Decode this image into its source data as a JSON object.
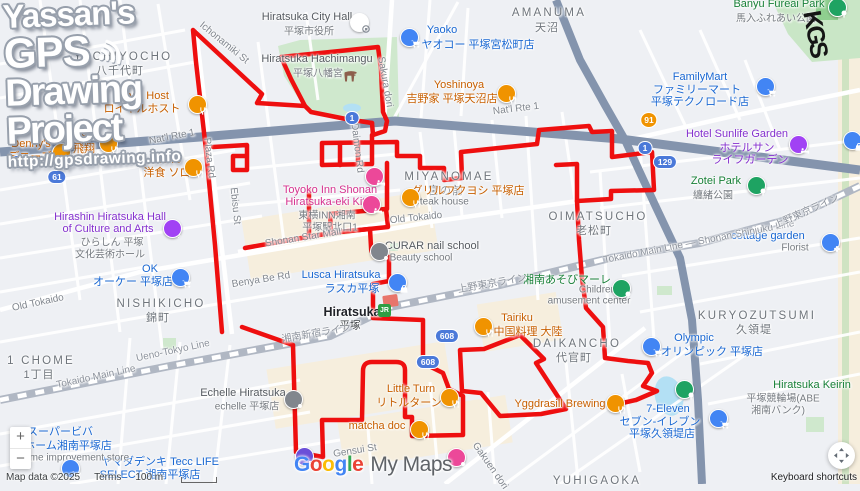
{
  "watermark": {
    "line1": "Yassan's",
    "line2": "GPS",
    "line3": "Drawing",
    "line4": "Project",
    "url": "http://gpsdrawing.info",
    "graffiti": "KGS"
  },
  "brand": {
    "google": "Google",
    "google_colors": [
      "#4285F4",
      "#EA4335",
      "#FBBC04",
      "#4285F4",
      "#34A853",
      "#EA4335"
    ],
    "mymaps": "My Maps"
  },
  "attribution": {
    "map_data": "Map data ©2025",
    "terms": "Terms",
    "scale": "100 m",
    "keyboard": "Keyboard shortcuts"
  },
  "controls": {
    "zoom_in": "+",
    "zoom_out": "−"
  },
  "station": {
    "jr_label": "JR"
  },
  "gps_track": {
    "color": "#ee0f0f",
    "width": 4.5,
    "strokes": [
      "M222,332 L215,245 L206,150 L196,62 L193,30 L262,94 L257,103 L305,106 L311,112 L346,119 L372,123",
      "M305,106 L291,79 L281,57 L340,51 L378,47 L381,70 L383,112 L387,121 L385,131 L373,135 L372,123",
      "M372,135 L372,164 L322,165 L322,143 L397,142 L397,156 L420,156 L420,168 L444,168 L444,180 L462,178 L461,152 L537,144 L539,130 L589,126 L592,132 L612,131 L612,157 L652,152 L654,190 L611,191 L611,199 L577,201 L579,240 L582,278 L586,308 L603,327 L605,358 L628,361 L648,363 L652,373 L643,386 L657,391 L636,400 L618,404",
      "M577,201 L577,164 L556,165",
      "M340,143 L340,165",
      "M358,142 L358,164",
      "M331,233 L330,214 L386,209 L388,227 L331,233",
      "M387,209 L387,163",
      "M213,147 L247,145 L247,170 L233,170 L233,156 L245,156",
      "M245,248 L290,240 L337,232 L370,229 L371,247 Q371,257 381,257 L389,257 L389,281 L373,284 L373,318 L398,319 L423,320 L423,363 L443,373 L449,389 L463,396 L463,435 L412,436 L412,417 L405,417 L405,370 Q405,362 396,362 L372,362 Q363,362 363,371 L362,420 L322,420 L323,457 L296,452 L293,345 L242,327",
      "M460,350 L484,349 L520,335 L544,359 L536,363 L566,409 L541,414 L500,416 L481,393 L462,391 L460,350",
      "M309,190 L309,237"
    ]
  },
  "map_texts": [
    {
      "t": "YACHIYOCHO",
      "x": 123,
      "y": 57,
      "cls": "dist"
    },
    {
      "t": "八千代町",
      "x": 120,
      "y": 70,
      "cls": "distk"
    },
    {
      "t": "MIYANOMAE",
      "x": 449,
      "y": 177,
      "cls": "dist"
    },
    {
      "t": "宮の前",
      "x": 446,
      "y": 190,
      "cls": "distk"
    },
    {
      "t": "AMANUMA",
      "x": 549,
      "y": 13,
      "cls": "dist"
    },
    {
      "t": "天沼",
      "x": 547,
      "y": 27,
      "cls": "distk"
    },
    {
      "t": "OIMATSUCHO",
      "x": 598,
      "y": 217,
      "cls": "dist"
    },
    {
      "t": "老松町",
      "x": 594,
      "y": 230,
      "cls": "distk"
    },
    {
      "t": "NISHIKICHO",
      "x": 161,
      "y": 304,
      "cls": "dist"
    },
    {
      "t": "錦町",
      "x": 158,
      "y": 317,
      "cls": "distk"
    },
    {
      "t": "DAIKANCHO",
      "x": 577,
      "y": 344,
      "cls": "dist"
    },
    {
      "t": "代官町",
      "x": 574,
      "y": 357,
      "cls": "distk"
    },
    {
      "t": "KURYOZUTSUMI",
      "x": 757,
      "y": 316,
      "cls": "dist"
    },
    {
      "t": "久領堤",
      "x": 754,
      "y": 329,
      "cls": "distk"
    },
    {
      "t": "1 CHOME",
      "x": 41,
      "y": 361,
      "cls": "dist"
    },
    {
      "t": "1丁目",
      "x": 39,
      "y": 374,
      "cls": "distk"
    },
    {
      "t": "YUHIGAOKA",
      "x": 597,
      "y": 481,
      "cls": "dist"
    },
    {
      "t": "Royal Host",
      "x": 142,
      "y": 96,
      "cls": "o"
    },
    {
      "t": "ロイヤルホスト",
      "x": 142,
      "y": 108,
      "cls": "o"
    },
    {
      "t": "Denny's",
      "x": 31,
      "y": 144,
      "cls": "o"
    },
    {
      "t": "デニーズ",
      "x": 30,
      "y": 156,
      "cls": "o"
    },
    {
      "t": "Hishō",
      "x": 85,
      "y": 136,
      "cls": "o"
    },
    {
      "t": "飛翔",
      "x": 84,
      "y": 148,
      "cls": "o"
    },
    {
      "t": "Zorro",
      "x": 168,
      "y": 160,
      "cls": "o"
    },
    {
      "t": "洋食 ソロ",
      "x": 167,
      "y": 172,
      "cls": "o"
    },
    {
      "t": "Yoshinoya",
      "x": 459,
      "y": 85,
      "cls": "o"
    },
    {
      "t": "吉野家 平塚天沼店",
      "x": 452,
      "y": 98,
      "cls": "o"
    },
    {
      "t": "グリルフクヨシ 平塚店",
      "x": 468,
      "y": 190,
      "cls": "o"
    },
    {
      "t": "Steak house",
      "x": 441,
      "y": 202,
      "cls": "sub"
    },
    {
      "t": "Tairiku",
      "x": 517,
      "y": 318,
      "cls": "o"
    },
    {
      "t": "中国料理 大陸",
      "x": 528,
      "y": 331,
      "cls": "o"
    },
    {
      "t": "Little Turn",
      "x": 411,
      "y": 389,
      "cls": "o"
    },
    {
      "t": "リトルターン",
      "x": 409,
      "y": 402,
      "cls": "o"
    },
    {
      "t": "matcha doc",
      "x": 377,
      "y": 426,
      "cls": "o"
    },
    {
      "t": "Yggdrasill Brewing",
      "x": 560,
      "y": 404,
      "cls": "o"
    },
    {
      "t": "Yaoko",
      "x": 442,
      "y": 30,
      "cls": "b"
    },
    {
      "t": "ヤオコー 平塚宮松町店",
      "x": 478,
      "y": 44,
      "cls": "b"
    },
    {
      "t": "FamilyMart",
      "x": 700,
      "y": 77,
      "cls": "b"
    },
    {
      "t": "ファミリーマート",
      "x": 697,
      "y": 89,
      "cls": "b"
    },
    {
      "t": "平塚テクノロード店",
      "x": 700,
      "y": 101,
      "cls": "b"
    },
    {
      "t": "OK",
      "x": 150,
      "y": 269,
      "cls": "b"
    },
    {
      "t": "オーケー 平塚店",
      "x": 133,
      "y": 281,
      "cls": "b"
    },
    {
      "t": "Olympic",
      "x": 694,
      "y": 338,
      "cls": "b"
    },
    {
      "t": "オリンピック 平塚店",
      "x": 712,
      "y": 351,
      "cls": "b"
    },
    {
      "t": "Lusca Hiratsuka",
      "x": 341,
      "y": 275,
      "cls": "b"
    },
    {
      "t": "ラスカ平塚",
      "x": 352,
      "y": 288,
      "cls": "b"
    },
    {
      "t": "ヤマダデンキ Tecc LIFE",
      "x": 160,
      "y": 461,
      "cls": "b"
    },
    {
      "t": "SELECT 湘南平塚店",
      "x": 150,
      "y": 474,
      "cls": "b"
    },
    {
      "t": "7-Eleven",
      "x": 668,
      "y": 409,
      "cls": "b"
    },
    {
      "t": "セブン-イレブン",
      "x": 660,
      "y": 421,
      "cls": "b"
    },
    {
      "t": "平塚久領堤店",
      "x": 662,
      "y": 433,
      "cls": "b"
    },
    {
      "t": "cottage garden",
      "x": 768,
      "y": 236,
      "cls": "b"
    },
    {
      "t": "Florist",
      "x": 795,
      "y": 248,
      "cls": "sub"
    },
    {
      "t": "スーパービバ",
      "x": 60,
      "y": 431,
      "cls": "b"
    },
    {
      "t": "ホーム湘南平塚店",
      "x": 68,
      "y": 445,
      "cls": "b"
    },
    {
      "t": "Home improvement store",
      "x": 73,
      "y": 458,
      "cls": "sub"
    },
    {
      "t": "Hotel Sunlife Garden",
      "x": 737,
      "y": 134,
      "cls": "p"
    },
    {
      "t": "ホテルサン",
      "x": 747,
      "y": 147,
      "cls": "p"
    },
    {
      "t": "ライフガーデン",
      "x": 750,
      "y": 159,
      "cls": "p"
    },
    {
      "t": "Hirashin Hiratsuka Hall",
      "x": 110,
      "y": 217,
      "cls": "p"
    },
    {
      "t": "of Culture and Arts",
      "x": 108,
      "y": 229,
      "cls": "p"
    },
    {
      "t": "ひらしん 平塚",
      "x": 112,
      "y": 241,
      "cls": "sub"
    },
    {
      "t": "文化芸術ホール",
      "x": 110,
      "y": 253,
      "cls": "sub"
    },
    {
      "t": "Toyoko Inn Shonan",
      "x": 330,
      "y": 190,
      "cls": "pk"
    },
    {
      "t": "Hiratsuka-eki Kita...",
      "x": 333,
      "y": 202,
      "cls": "pk"
    },
    {
      "t": "東横INN湘南",
      "x": 327,
      "y": 214,
      "cls": "sub"
    },
    {
      "t": "平塚駅北口1",
      "x": 330,
      "y": 226,
      "cls": "sub"
    },
    {
      "t": "Banyu Fureai Park",
      "x": 779,
      "y": 4,
      "cls": "g"
    },
    {
      "t": "馬入ふれあい公園",
      "x": 776,
      "y": 17,
      "cls": "sub"
    },
    {
      "t": "Zotei Park",
      "x": 716,
      "y": 181,
      "cls": "g"
    },
    {
      "t": "纏緒公園",
      "x": 713,
      "y": 194,
      "cls": "sub"
    },
    {
      "t": "湘南あそびマーレ",
      "x": 567,
      "y": 279,
      "cls": "g"
    },
    {
      "t": "Children's",
      "x": 601,
      "y": 290,
      "cls": "sub"
    },
    {
      "t": "amusement center",
      "x": 589,
      "y": 301,
      "cls": "sub"
    },
    {
      "t": "Hiratsuka Keirin",
      "x": 812,
      "y": 385,
      "cls": "g"
    },
    {
      "t": "平塚競輪場(ABE",
      "x": 783,
      "y": 397,
      "cls": "sub"
    },
    {
      "t": "湘南バンク)",
      "x": 778,
      "y": 409,
      "cls": "sub"
    },
    {
      "t": "Hiratsuka City Hall",
      "x": 307,
      "y": 17,
      "cls": "gy"
    },
    {
      "t": "平塚市役所",
      "x": 309,
      "y": 30,
      "cls": "sub"
    },
    {
      "t": "Hiratsuka Hachimangu",
      "x": 317,
      "y": 59,
      "cls": "gy"
    },
    {
      "t": "平塚八幡宮",
      "x": 318,
      "y": 72,
      "cls": "sub"
    },
    {
      "t": "CURAR nail school",
      "x": 432,
      "y": 246,
      "cls": "gy"
    },
    {
      "t": "Beauty school",
      "x": 421,
      "y": 258,
      "cls": "sub"
    },
    {
      "t": "Echelle Hiratsuka",
      "x": 243,
      "y": 393,
      "cls": "gy"
    },
    {
      "t": "echelle 平塚店",
      "x": 247,
      "y": 405,
      "cls": "sub"
    },
    {
      "t": "Hiratsuka",
      "x": 352,
      "y": 312,
      "cls": "st",
      "name": "station-name"
    },
    {
      "t": "平塚",
      "x": 350,
      "y": 325,
      "cls": "stk",
      "name": "station-name-jp"
    },
    {
      "t": "Nat'l Rte 1",
      "x": 172,
      "y": 137,
      "cls": "road",
      "rot": -11
    },
    {
      "t": "Nat'l Rte 1",
      "x": 516,
      "y": 109,
      "cls": "road",
      "rot": -7
    },
    {
      "t": "Old Tokaido",
      "x": 38,
      "y": 303,
      "cls": "road",
      "rot": -12
    },
    {
      "t": "Old Tokaido",
      "x": 416,
      "y": 218,
      "cls": "road",
      "rot": -6
    },
    {
      "t": "Plaza Rd",
      "x": 209,
      "y": 158,
      "cls": "road",
      "rot": 83
    },
    {
      "t": "Sakura dori",
      "x": 385,
      "y": 82,
      "cls": "road",
      "rot": 80
    },
    {
      "t": "Ichonamiki St",
      "x": 224,
      "y": 43,
      "cls": "road",
      "rot": 39
    },
    {
      "t": "Ebisu St",
      "x": 235,
      "y": 206,
      "cls": "road",
      "rot": 84
    },
    {
      "t": "Daimon Rd",
      "x": 357,
      "y": 148,
      "cls": "road",
      "rot": 83
    },
    {
      "t": "Benya Be Rd",
      "x": 261,
      "y": 280,
      "cls": "road",
      "rot": -9
    },
    {
      "t": "Shonan Star Mall",
      "x": 303,
      "y": 238,
      "cls": "road",
      "rot": -9
    },
    {
      "t": "Gakuen dori",
      "x": 490,
      "y": 466,
      "cls": "road",
      "rot": 55
    },
    {
      "t": "Gensui St",
      "x": 355,
      "y": 451,
      "cls": "road",
      "rot": -9
    },
    {
      "t": "Ueno-Tokyo Line",
      "x": 173,
      "y": 351,
      "cls": "rail",
      "rot": -12
    },
    {
      "t": "Tokaido Main Line",
      "x": 96,
      "y": 377,
      "cls": "rail",
      "rot": -12
    },
    {
      "t": "上野東京ライン",
      "x": 492,
      "y": 282,
      "cls": "rail",
      "rot": -10
    },
    {
      "t": "湘南新宿ライン",
      "x": 316,
      "y": 332,
      "cls": "rail",
      "rot": -10
    },
    {
      "t": "Tokaido Main Line — Shonan-Shinjuku Line",
      "x": 699,
      "y": 242,
      "cls": "rail",
      "rot": -11
    },
    {
      "t": "上野東京ライン",
      "x": 806,
      "y": 210,
      "cls": "rail",
      "rot": -24
    }
  ],
  "markers": [
    {
      "n": "royal-host",
      "x": 196,
      "y": 103,
      "c": "#f09300",
      "g": "fork"
    },
    {
      "n": "dennys",
      "x": 60,
      "y": 151,
      "c": "#f09300",
      "g": "fork"
    },
    {
      "n": "hisho",
      "x": 107,
      "y": 142,
      "c": "#f09300",
      "g": "fork"
    },
    {
      "n": "zorro",
      "x": 192,
      "y": 166,
      "c": "#f09300",
      "g": "fork"
    },
    {
      "n": "yoshinoya",
      "x": 505,
      "y": 92,
      "c": "#f09300",
      "g": "fork"
    },
    {
      "n": "grill-fukuyoshi",
      "x": 409,
      "y": 196,
      "c": "#f09300",
      "g": "fork"
    },
    {
      "n": "tairiku",
      "x": 482,
      "y": 325,
      "c": "#f09300",
      "g": "fork"
    },
    {
      "n": "little-turn",
      "x": 448,
      "y": 396,
      "c": "#f09300",
      "g": "fork"
    },
    {
      "n": "matcha-doc",
      "x": 418,
      "y": 428,
      "c": "#f09300",
      "g": "fork"
    },
    {
      "n": "yggdrasill-brewing",
      "x": 614,
      "y": 402,
      "c": "#f09300",
      "g": "fork"
    },
    {
      "n": "yaoko",
      "x": 408,
      "y": 36,
      "c": "#4285f4",
      "g": "cart"
    },
    {
      "n": "familymart",
      "x": 764,
      "y": 85,
      "c": "#4285f4",
      "g": "cart"
    },
    {
      "n": "ok-store",
      "x": 179,
      "y": 276,
      "c": "#4285f4",
      "g": "cart"
    },
    {
      "n": "olympic",
      "x": 650,
      "y": 345,
      "c": "#4285f4",
      "g": "cart"
    },
    {
      "n": "lusca",
      "x": 396,
      "y": 281,
      "c": "#4285f4",
      "g": "bag"
    },
    {
      "n": "yamada-denki",
      "x": 69,
      "y": 467,
      "c": "#4285f4",
      "g": "cart"
    },
    {
      "n": "seven-eleven",
      "x": 717,
      "y": 417,
      "c": "#4285f4",
      "g": "cart"
    },
    {
      "n": "cottage-garden",
      "x": 829,
      "y": 241,
      "c": "#4285f4",
      "g": "flower"
    },
    {
      "n": "shop-east",
      "x": 851,
      "y": 139,
      "c": "#4285f4",
      "g": "bag"
    },
    {
      "n": "hotel-sunlife",
      "x": 797,
      "y": 143,
      "c": "#a142f4",
      "g": "bed"
    },
    {
      "n": "hirashin-hall",
      "x": 171,
      "y": 227,
      "c": "#a142f4",
      "g": "note"
    },
    {
      "n": "toyoko-inn-1",
      "x": 373,
      "y": 175,
      "c": "#ec4899",
      "g": "bed"
    },
    {
      "n": "toyoko-inn-2",
      "x": 370,
      "y": 203,
      "c": "#ec4899",
      "g": "bed"
    },
    {
      "n": "banyu-park",
      "x": 836,
      "y": 6,
      "c": "#1ea362",
      "g": "tree"
    },
    {
      "n": "zotei-park",
      "x": 755,
      "y": 184,
      "c": "#1ea362",
      "g": "tree"
    },
    {
      "n": "asobi-marle",
      "x": 620,
      "y": 287,
      "c": "#1ea362",
      "g": "tree"
    },
    {
      "n": "hiratsuka-keirin",
      "x": 683,
      "y": 388,
      "c": "#1ea362",
      "g": "tree"
    },
    {
      "n": "city-hall",
      "x": 358,
      "y": 21,
      "c": "#ffffff",
      "g": "gov"
    },
    {
      "n": "curar",
      "x": 378,
      "y": 250,
      "c": "#81868d",
      "g": "dot"
    },
    {
      "n": "echelle",
      "x": 292,
      "y": 398,
      "c": "#81868d",
      "g": "dot"
    },
    {
      "n": "parking",
      "x": 303,
      "y": 455,
      "c": "#6b4fd8",
      "g": "P"
    },
    {
      "n": "pink-poi",
      "x": 455,
      "y": 456,
      "c": "#ec4899",
      "g": "dot"
    },
    {
      "n": "hachimangu-torii",
      "x": 344,
      "y": 70,
      "c": "none",
      "g": "torii"
    }
  ],
  "shields": [
    {
      "t": "1",
      "x": 17,
      "y": 162,
      "c": "bl"
    },
    {
      "t": "61",
      "x": 57,
      "y": 177,
      "c": "bl"
    },
    {
      "t": "1",
      "x": 352,
      "y": 118,
      "c": "bl"
    },
    {
      "t": "1",
      "x": 645,
      "y": 148,
      "c": "bl"
    },
    {
      "t": "91",
      "x": 649,
      "y": 120,
      "c": "or"
    },
    {
      "t": "129",
      "x": 665,
      "y": 162,
      "c": "bl"
    },
    {
      "t": "608",
      "x": 447,
      "y": 336,
      "c": "bl"
    },
    {
      "t": "608",
      "x": 428,
      "y": 362,
      "c": "bl"
    }
  ]
}
